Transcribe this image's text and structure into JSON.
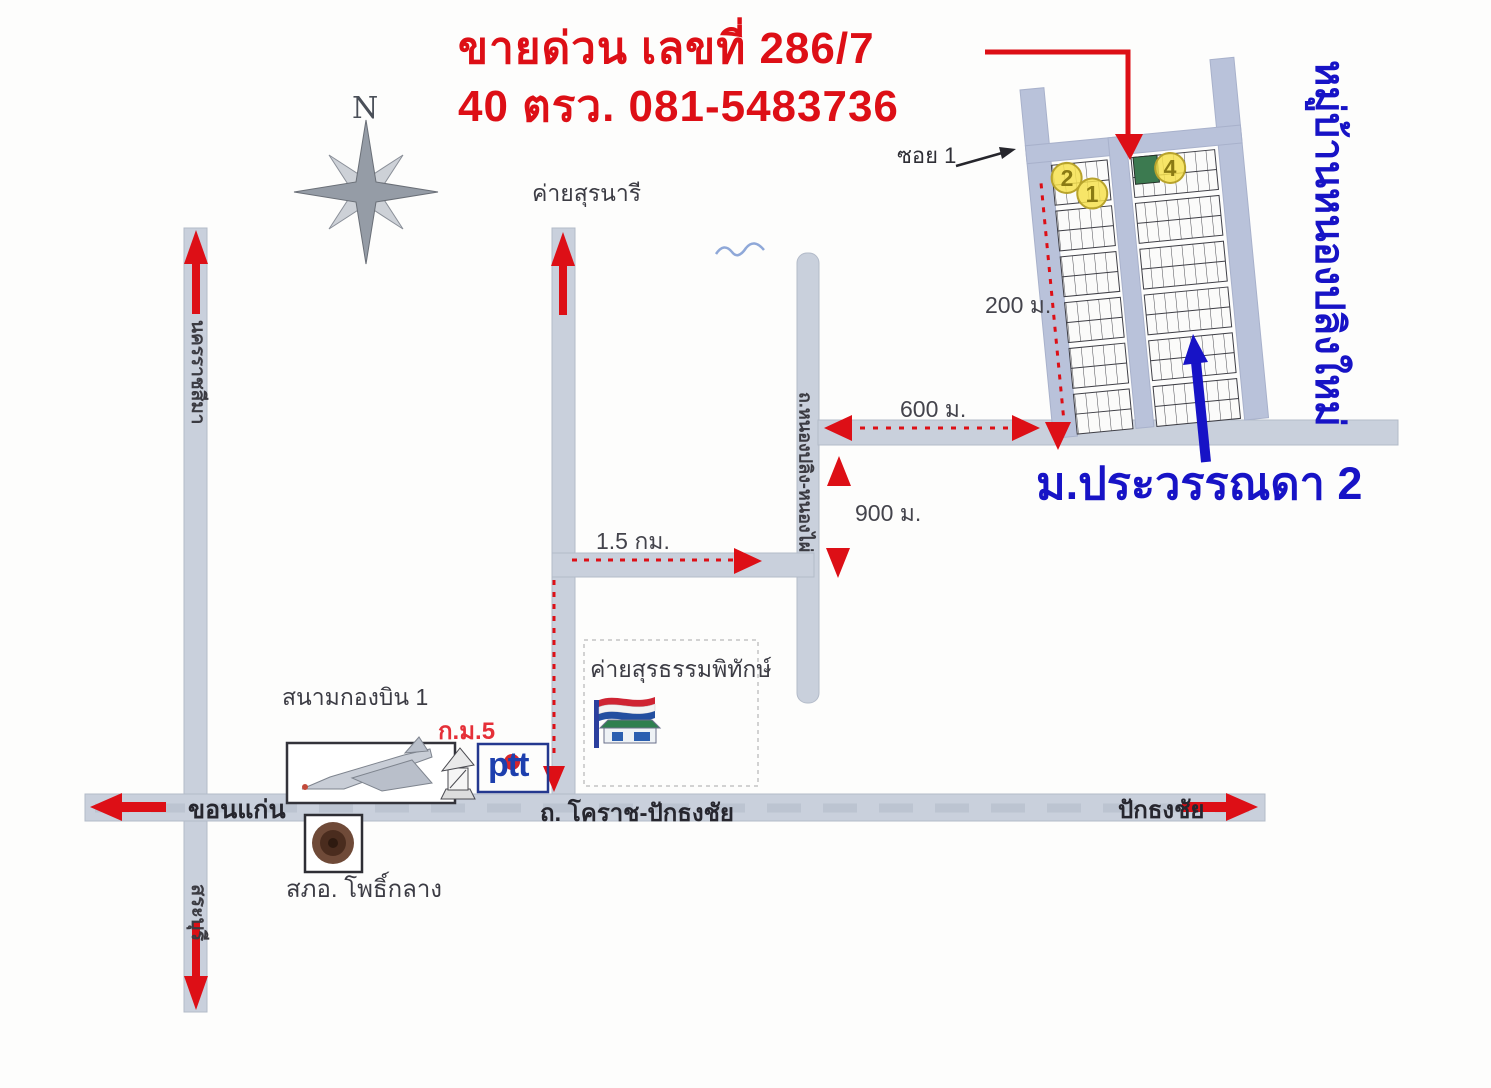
{
  "title": {
    "line1": "ขายด่วน เลขที่ 286/7",
    "line2": "40 ตรว. 081-5483736"
  },
  "compass": {
    "north_label": "N"
  },
  "subdivision": {
    "soi_label": "ซอย 1",
    "plot_numbers": [
      "2",
      "1",
      "4"
    ],
    "village_name_side": "หมู่บ้านหนองปลิงใหม่",
    "estate_name": "ม.ประวรรณดา 2"
  },
  "distances": {
    "to_soi": "200 ม.",
    "along_road": "600 ม.",
    "between_junctions": "900 ม.",
    "connector": "1.5 กม."
  },
  "roads": {
    "main_road": "ถ. โคราช-ปักธงชัย",
    "west_direction": "ขอนแก่น",
    "east_direction": "ปักธงชัย",
    "north_direction": "นครราชสีมา",
    "south_direction": "สระบุรี",
    "east_vertical_road": "ถ.หนองปลิง-หนองไผ่"
  },
  "landmarks": {
    "camp_suranari": "ค่ายสุรนารี",
    "camp_surathampitak": "ค่ายสุรธรรมพิทักษ์",
    "airbase": "สนามกองบิน 1",
    "km_marker": "ก.ม.5",
    "gas_station": "ptt",
    "police_station": "สภอ. โพธิ์กลาง"
  },
  "colors": {
    "highlight_red": "#dd0f16",
    "accent_blue": "#1713c6",
    "road_fill": "#c9d0dc",
    "plot_green": "#3c7a50",
    "plot_yellow": "#f6e14e"
  }
}
